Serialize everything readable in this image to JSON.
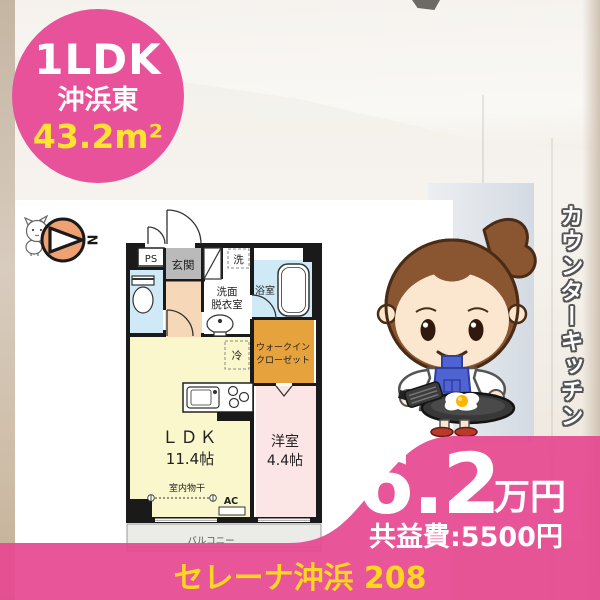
{
  "badge": {
    "layout": "1LDK",
    "location": "沖浜東",
    "area": "43.2m²"
  },
  "floorplan": {
    "north_label": "N",
    "rooms": {
      "ps": "PS",
      "entrance": "玄関",
      "washer": "洗",
      "washroom_l1": "洗面",
      "washroom_l2": "脱衣室",
      "bathroom": "浴室",
      "closet_l1": "ウォークイン",
      "closet_l2": "クローゼット",
      "fridge": "冷",
      "ldk_name": "ＬＤＫ",
      "ldk_size": "11.4帖",
      "bedroom_name": "洋室",
      "bedroom_size": "4.4帖",
      "indoor_drying": "室内物干",
      "ac": "AC",
      "balcony": "バルコニー"
    }
  },
  "feature_label": "カウンターキッチン",
  "price": {
    "rent": "6.2",
    "unit": "万円",
    "common_fee": "共益費:5500円"
  },
  "footer": {
    "property_name": "セレーナ沖浜 208"
  },
  "colors": {
    "brand_pink": "#e8529b",
    "band_pink": "#e64890",
    "accent_yellow": "#ffe32e",
    "footer_yellow": "#ffd71e",
    "compass_orange": "#f0a173",
    "wic_orange": "#e6a23c",
    "ldk_yellow": "#fbf7cd",
    "bedroom_pink": "#fce5e5",
    "wet_area_blue": "#cfeaf6",
    "hall_peach": "#f6d8b8",
    "entrance_gray": "#bababa"
  }
}
